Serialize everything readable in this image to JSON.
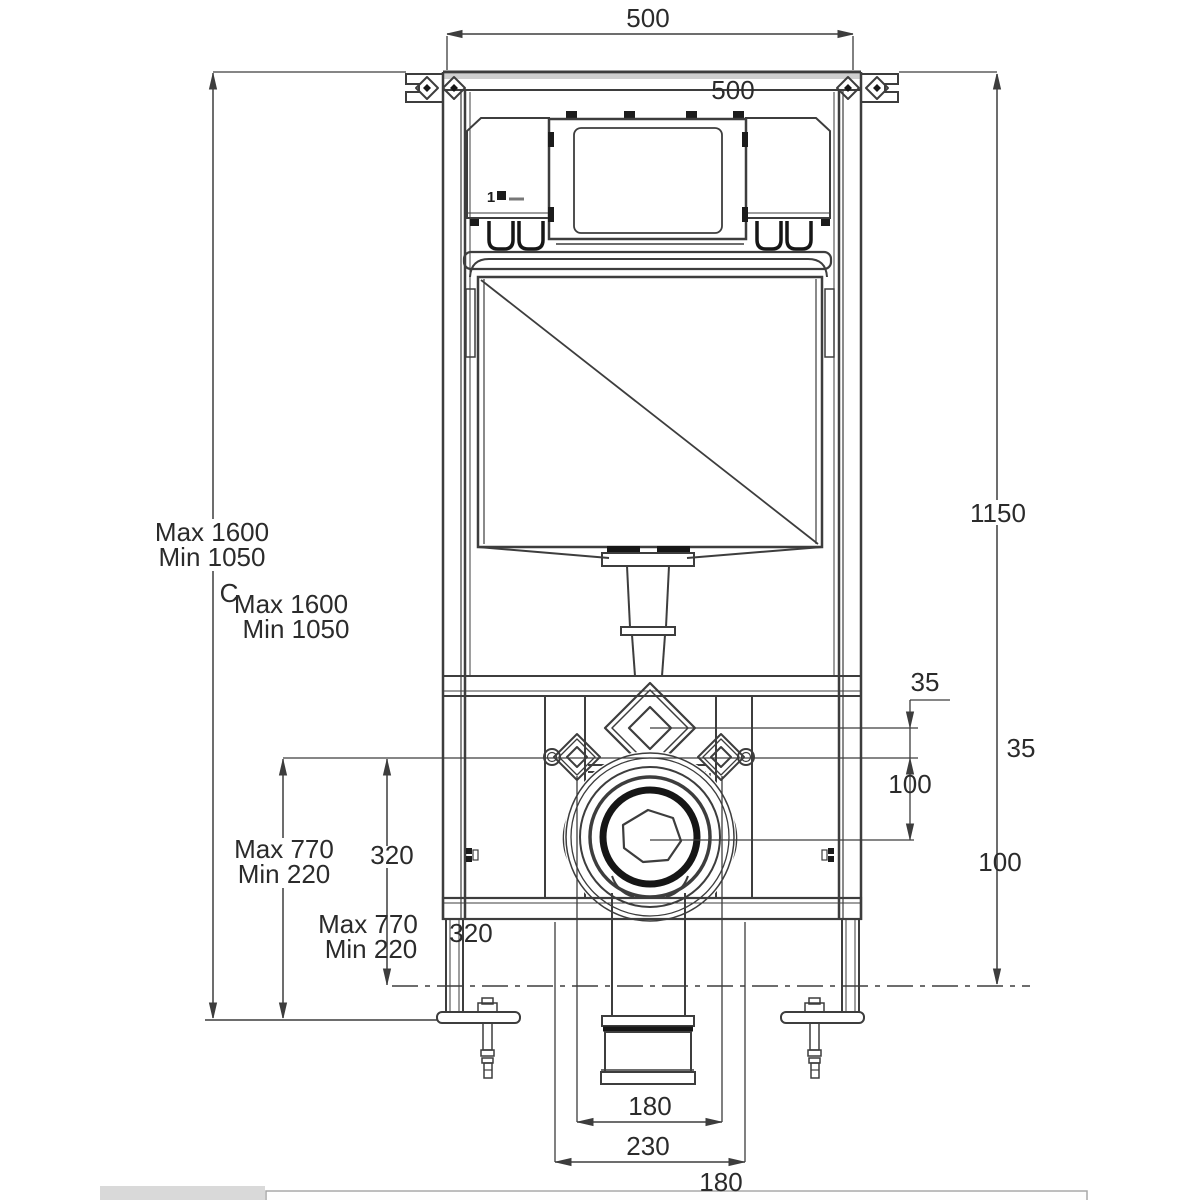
{
  "drawing": {
    "labels": {
      "top_width": "500",
      "top_width_inner": "500",
      "height_max": "Max 1600",
      "height_min": "Min 1050",
      "c_note": "C",
      "height_max_dup": "Max 1600",
      "height_min_dup": "Min 1050",
      "right_height": "1150",
      "offset_35": "35",
      "offset_35_dup": "35",
      "offset_100": "100",
      "offset_100_dup": "100",
      "bolt_max": "Max 770",
      "bolt_min": "Min 220",
      "bolt_max_dup": "Max 770",
      "bolt_min_dup": "Min 220",
      "offset_320": "320",
      "offset_320_dup": "320",
      "outlet_width": "180",
      "outlet_width_dup": "180",
      "flange_width": "230",
      "flush_unit_marking": "1"
    },
    "colors": {
      "line": "#3d3d3d",
      "dark": "#161616",
      "text": "#2b2b2b",
      "background": "#ffffff",
      "footer_gray": "#d9d9d9"
    }
  }
}
